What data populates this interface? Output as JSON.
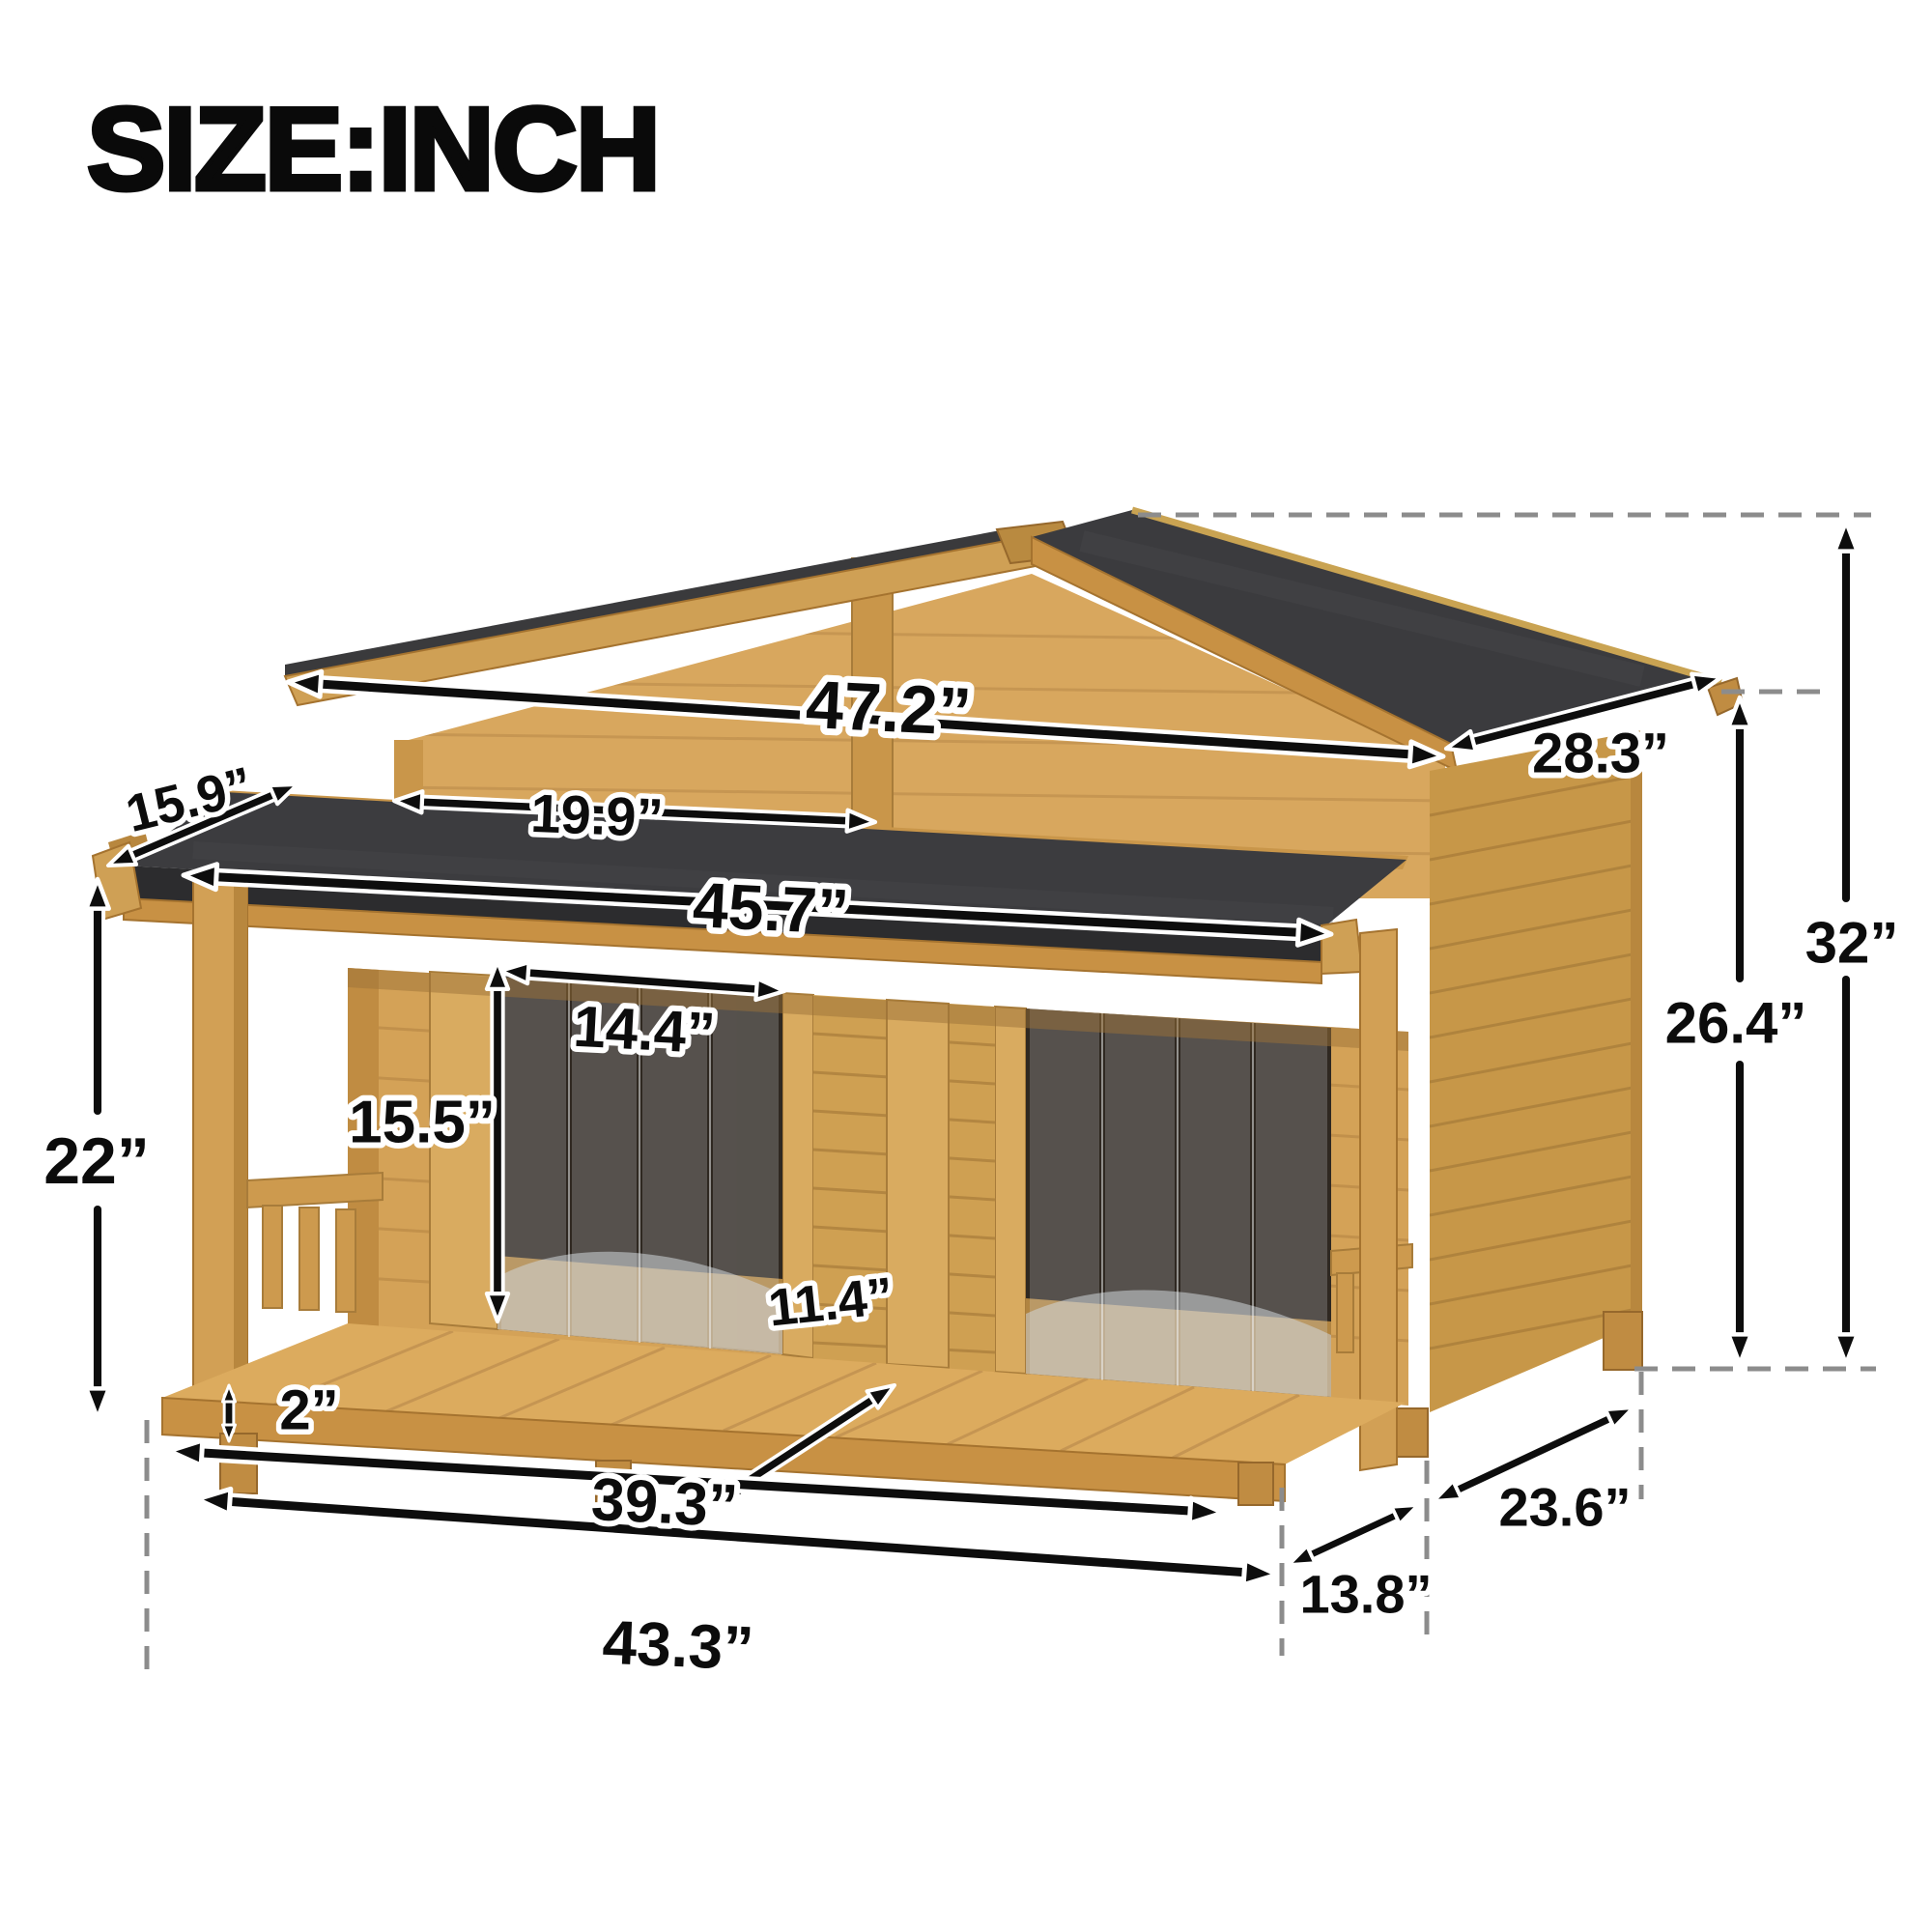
{
  "title": "SIZE:INCH",
  "dimensions": {
    "roof_width": "47.2”",
    "roof_depth": "28.3”",
    "awning_overhang": "15.9”",
    "gable_section_width": "19.9”",
    "awning_width": "45.7”",
    "door_width": "14.4”",
    "door_height": "15.5”",
    "porch_height": "22”",
    "total_height": "32”",
    "body_height": "26.4”",
    "floor_recess": "11.4”",
    "floor_thickness": "2”",
    "porch_floor_width": "39.3”",
    "base_width": "43.3”",
    "house_depth": "23.6”",
    "porch_depth": "13.8”"
  },
  "colors": {
    "wood_light": "#d2a055",
    "wood_mid": "#c89144",
    "wood_dark": "#b8873e",
    "roof_felt": "#3b3b3e",
    "arrow": "#0d0d0d",
    "arrow_casing": "#ffffff",
    "dashed_guide": "#8c8c8c",
    "title_text": "#0a0a0a"
  }
}
